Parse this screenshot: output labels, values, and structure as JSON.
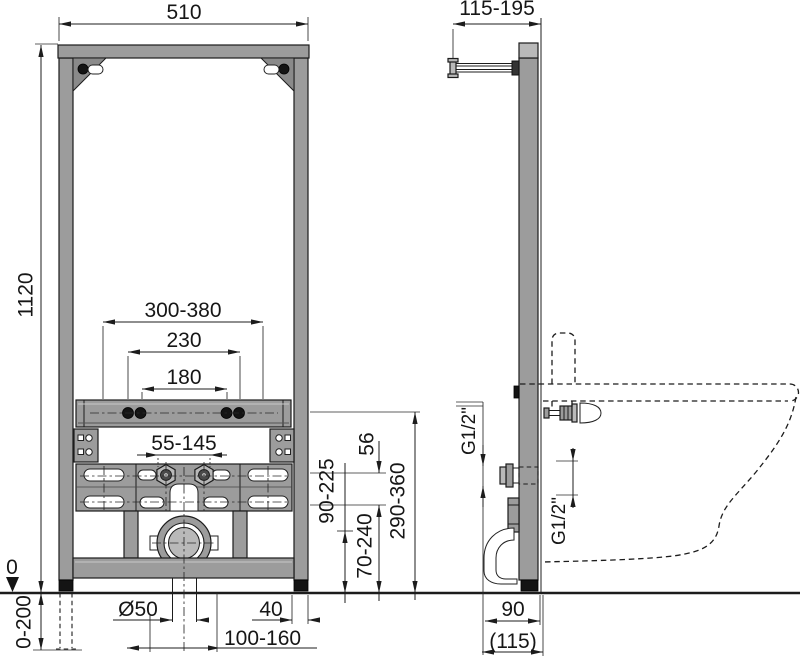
{
  "drawing_title": "bidet-installation-frame-technical-drawing",
  "front_view": {
    "frame_width": "510",
    "frame_height": "1120",
    "stud_spacing_range": "300-380",
    "stud_spacing_230": "230",
    "stud_spacing_180": "180",
    "bolt_spacing_range": "55-145",
    "floor_reference": "0",
    "leg_adjustment_range": "0-200",
    "drain_diameter": "Ø50",
    "profile_width": "40",
    "drain_offset_range": "100-160",
    "height_water": "90-225",
    "height_offset": "56",
    "height_drain": "70-240",
    "height_studs": "290-360"
  },
  "side_view": {
    "depth_range": "115-195",
    "water_connection_rear": "G1/2\"",
    "water_connection_front": "G1/2\"",
    "outlet_wall_distance": "90",
    "outlet_wall_distance_alt": "(115)"
  },
  "colors": {
    "background": "#ffffff",
    "line": "#1c1c1c",
    "metal": "#9c9c9c",
    "metal_light": "#b9b9b9",
    "black_part": "#141414"
  }
}
